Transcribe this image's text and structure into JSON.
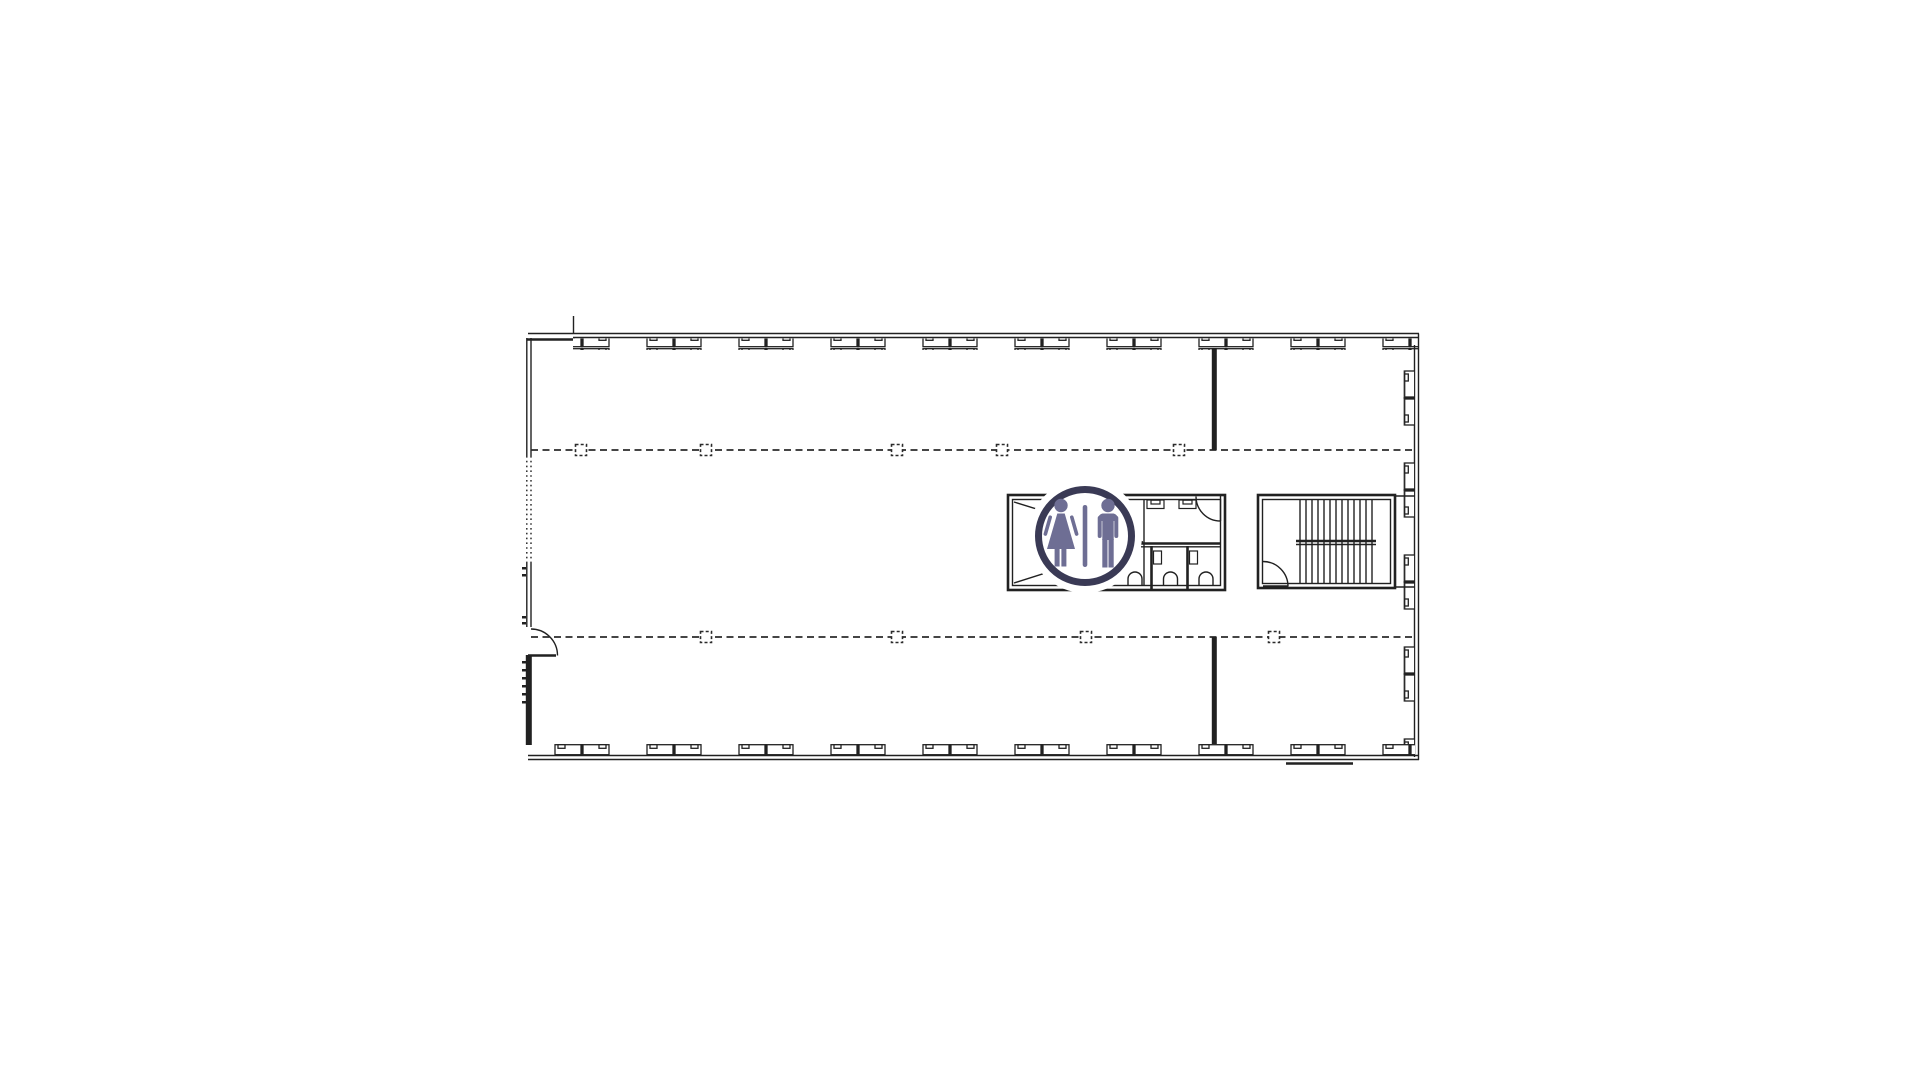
{
  "page": {
    "background": "#ffffff"
  },
  "colors": {
    "background": "#ffffff",
    "line": "#212121",
    "grid": "#2b2b2b",
    "sign_ring": "#3a3a55",
    "sign_figure": "#6e6e94",
    "sign_background": "#ffffff"
  },
  "floorplan": {
    "sign_icon": "unisex-restroom-icon",
    "grid": {
      "upper_gridline_marker_count": 5,
      "lower_gridline_marker_count": 4
    },
    "restroom": {
      "toilet_count": 3,
      "sink_count": 2,
      "stall_partition_count": 2,
      "door_count": 1
    },
    "stairwell": {
      "tread_line_count": 13,
      "door_count": 1
    },
    "entry": {
      "door_count": 1
    }
  }
}
